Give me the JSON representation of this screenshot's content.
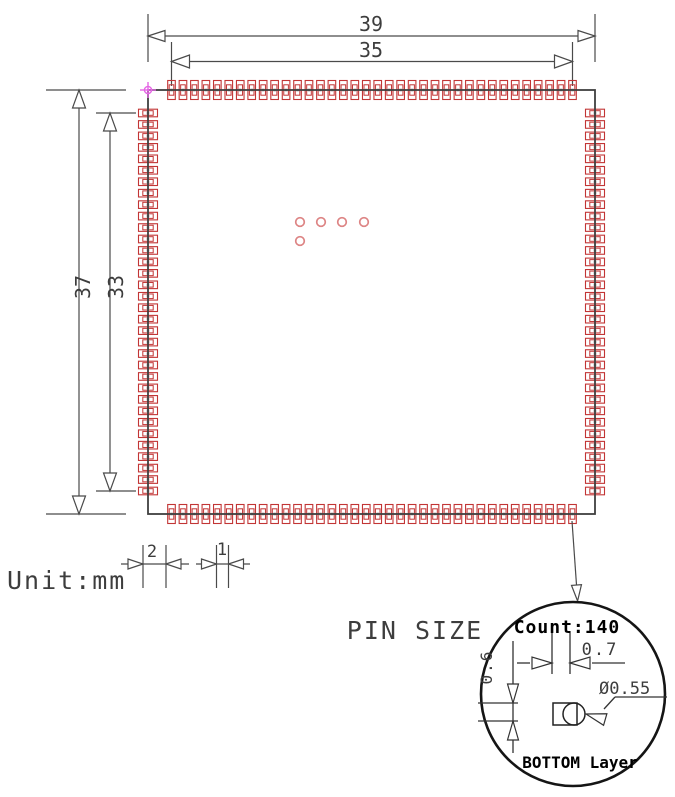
{
  "drawing": {
    "title": "IC package footprint drawing",
    "unit_label": "Unit:mm",
    "pin_size_label": "PIN SIZE",
    "dimensions": {
      "outer_width": "39",
      "inner_width": "35",
      "outer_height": "37",
      "inner_height": "33",
      "legend_pitch_large": "2",
      "legend_pitch_small": "1"
    },
    "detail_view": {
      "count_label": "Count:140",
      "pad_width": "0.7",
      "pad_height": "0.6",
      "hole_diameter": "Ø0.55",
      "layer_label": "BOTTOM Layer"
    },
    "pads": {
      "top_count": 36,
      "bottom_count": 36,
      "left_count": 34,
      "right_count": 34,
      "total": 140
    },
    "center_marks": [
      [
        300,
        222
      ],
      [
        321,
        222
      ],
      [
        342,
        222
      ],
      [
        364,
        222
      ],
      [
        300,
        241
      ]
    ],
    "colors": {
      "pad": "#c23535",
      "via": "#dd8484",
      "origin_marker": "#e466e4",
      "outline": "#3f3f3f",
      "dimension": "#4a4a4a",
      "detail": "#151515"
    }
  }
}
